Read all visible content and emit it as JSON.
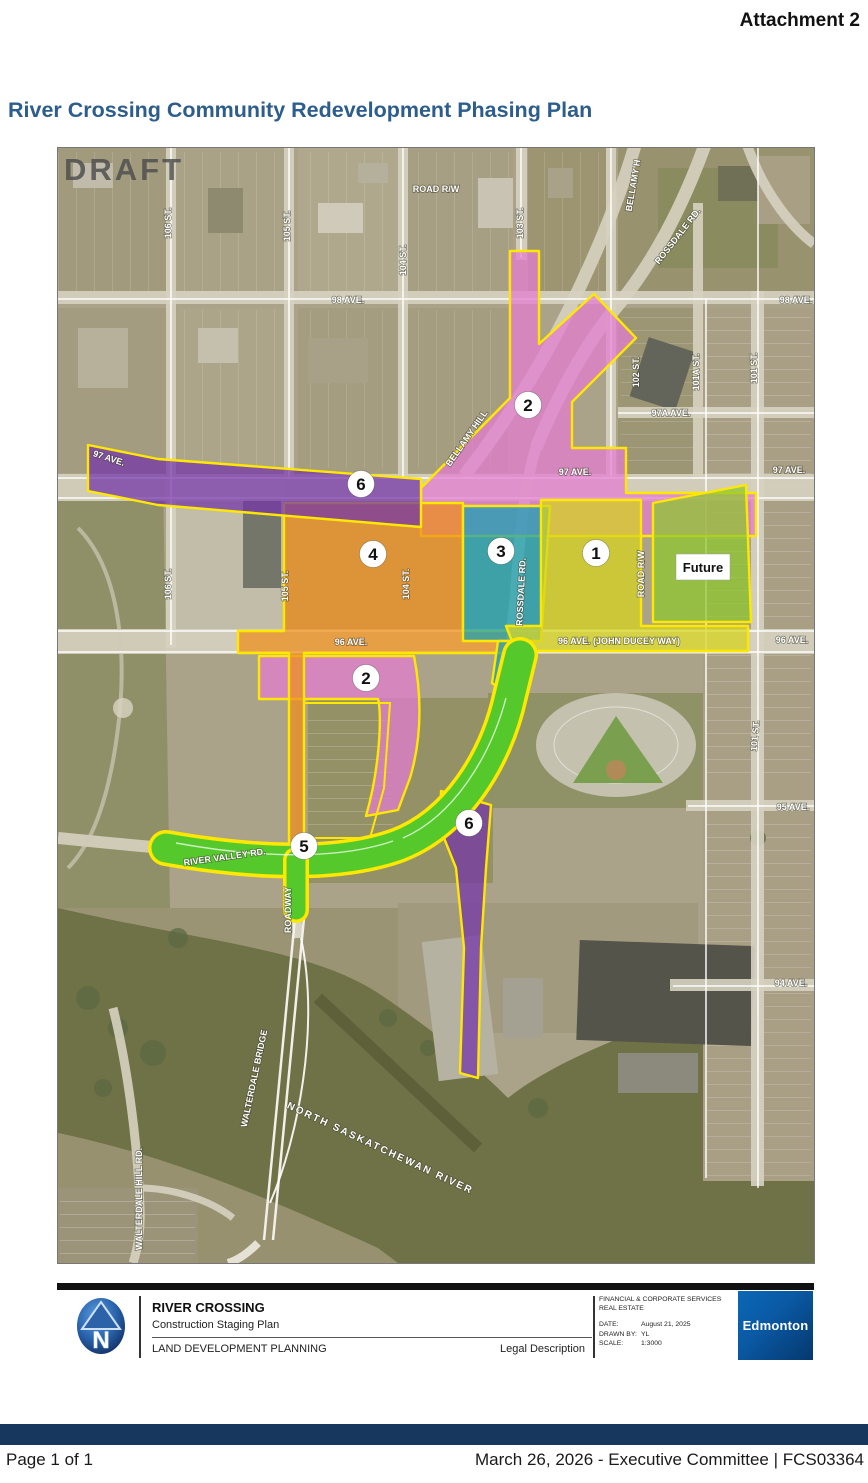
{
  "page": {
    "attachment_label": "Attachment 2",
    "title": "River Crossing Community Redevelopment Phasing Plan",
    "footer": {
      "page_label": "Page 1 of 1",
      "meeting_label": "March 26, 2026 - Executive Committee | FCS03364"
    }
  },
  "map": {
    "draft_watermark": "DRAFT",
    "future_label": "Future",
    "colors": {
      "phase1_yellow": "#d6d41e",
      "phase2_pink": "#e27cd0",
      "phase3_teal": "#19a0b4",
      "phase4_orange": "#ef8f1e",
      "phase5_green": "#3ec432",
      "phase6_purple": "#7434a8",
      "future_lime": "#8fc82e",
      "outline_yellow": "#ffe800",
      "river_olive": "#6f7147",
      "title_blue": "#2d5d8c",
      "footer_navy": "#17375e"
    },
    "phase_circles": [
      {
        "n": "2",
        "x": 470,
        "y": 257
      },
      {
        "n": "6",
        "x": 303,
        "y": 336
      },
      {
        "n": "4",
        "x": 315,
        "y": 406
      },
      {
        "n": "3",
        "x": 443,
        "y": 403
      },
      {
        "n": "1",
        "x": 538,
        "y": 405
      },
      {
        "n": "2",
        "x": 308,
        "y": 530
      },
      {
        "n": "6",
        "x": 411,
        "y": 675
      },
      {
        "n": "5",
        "x": 246,
        "y": 698
      }
    ],
    "street_labels": [
      {
        "text": "ROAD R/W",
        "x": 378,
        "y": 44,
        "r": 0,
        "s": 9
      },
      {
        "text": "106 ST.",
        "x": 113,
        "y": 75,
        "r": -90,
        "s": 9
      },
      {
        "text": "105 ST.",
        "x": 232,
        "y": 78,
        "r": -90,
        "s": 9
      },
      {
        "text": "104 ST.",
        "x": 348,
        "y": 112,
        "r": -90,
        "s": 9
      },
      {
        "text": "103 ST.",
        "x": 465,
        "y": 75,
        "r": -90,
        "s": 9
      },
      {
        "text": "BELLAMY H",
        "x": 578,
        "y": 38,
        "r": -80,
        "s": 9
      },
      {
        "text": "ROSSDALE RD.",
        "x": 622,
        "y": 90,
        "r": -52,
        "s": 9
      },
      {
        "text": "98 AVE.",
        "x": 290,
        "y": 155,
        "r": 0,
        "s": 9
      },
      {
        "text": "98 AVE.",
        "x": 738,
        "y": 155,
        "r": 0,
        "s": 9
      },
      {
        "text": "97 AVE.",
        "x": 50,
        "y": 313,
        "r": 18,
        "s": 9
      },
      {
        "text": "97 AVE.",
        "x": 517,
        "y": 327,
        "r": 0,
        "s": 9
      },
      {
        "text": "97 AVE.",
        "x": 731,
        "y": 325,
        "r": 0,
        "s": 9
      },
      {
        "text": "97A AVE.",
        "x": 613,
        "y": 268,
        "r": 0,
        "s": 9
      },
      {
        "text": "102 ST.",
        "x": 581,
        "y": 224,
        "r": -90,
        "s": 9
      },
      {
        "text": "101A ST.",
        "x": 641,
        "y": 224,
        "r": -90,
        "s": 9
      },
      {
        "text": "101 ST.",
        "x": 699,
        "y": 220,
        "r": -90,
        "s": 9
      },
      {
        "text": "BELLAMY HILL",
        "x": 411,
        "y": 292,
        "r": -55,
        "s": 9
      },
      {
        "text": "106 ST.",
        "x": 113,
        "y": 436,
        "r": -90,
        "s": 9
      },
      {
        "text": "105 ST.",
        "x": 230,
        "y": 438,
        "r": -90,
        "s": 9
      },
      {
        "text": "104 ST.",
        "x": 351,
        "y": 436,
        "r": -90,
        "s": 9
      },
      {
        "text": "ROSSDALE RD.",
        "x": 466,
        "y": 444,
        "r": -87,
        "s": 9
      },
      {
        "text": "ROAD R/W",
        "x": 586,
        "y": 426,
        "r": -90,
        "s": 9
      },
      {
        "text": "96 AVE.",
        "x": 293,
        "y": 497,
        "r": 0,
        "s": 9
      },
      {
        "text": "96 AVE. (JOHN DUCEY WAY)",
        "x": 561,
        "y": 496,
        "r": 0,
        "s": 9
      },
      {
        "text": "96 AVE.",
        "x": 734,
        "y": 495,
        "r": 0,
        "s": 9
      },
      {
        "text": "101 ST.",
        "x": 700,
        "y": 588,
        "r": -85,
        "s": 9
      },
      {
        "text": "95 AVE.",
        "x": 735,
        "y": 662,
        "r": 0,
        "s": 9
      },
      {
        "text": "RIVER VALLEY RD.",
        "x": 167,
        "y": 712,
        "r": -8,
        "s": 9
      },
      {
        "text": "ROADWAY",
        "x": 233,
        "y": 762,
        "r": -90,
        "s": 9
      },
      {
        "text": "94 AVE.",
        "x": 733,
        "y": 838,
        "r": 0,
        "s": 9
      },
      {
        "text": "WALTERDALE BRIDGE",
        "x": 199,
        "y": 931,
        "r": -78,
        "s": 9
      },
      {
        "text": "NORTH SASKATCHEWAN RIVER",
        "x": 321,
        "y": 1003,
        "r": 25,
        "s": 10,
        "ls": 2
      },
      {
        "text": "WALTERDALE HILL RD.",
        "x": 84,
        "y": 1051,
        "r": -90,
        "s": 9
      }
    ]
  },
  "title_block": {
    "project": "RIVER CROSSING",
    "subtitle": "Construction Staging Plan",
    "department": "LAND DEVELOPMENT PLANNING",
    "legal": "Legal Description",
    "org_line1": "FINANCIAL & CORPORATE SERVICES",
    "org_line2": "REAL ESTATE",
    "date_label": "DATE:",
    "date_value": "August 21, 2025",
    "drawn_label": "DRAWN BY:",
    "drawn_value": "YL",
    "scale_label": "SCALE:",
    "scale_value": "1:3000",
    "logo_text": "Edmonton",
    "north_letter": "N"
  }
}
